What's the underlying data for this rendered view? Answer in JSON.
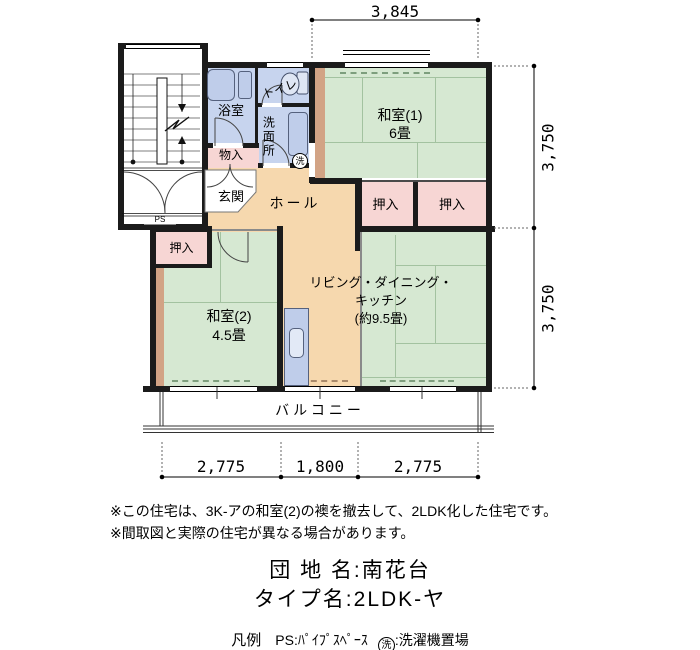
{
  "plan": {
    "rooms": {
      "washitsu1": {
        "name": "和室(1)",
        "size": "6畳"
      },
      "washitsu2": {
        "name": "和室(2)",
        "size": "4.5畳"
      },
      "ldk": {
        "line1": "リビング・ダイニング・",
        "line2": "キッチン",
        "line3": "(約9.5畳)"
      },
      "hall": "ホール",
      "genkan": "玄関",
      "bath": "浴室",
      "toilet": "トイレ",
      "washroom": "洗面所",
      "monoire": "物入",
      "oshiire": "押入",
      "balcony": "バルコニー",
      "ps": "PS",
      "laundry_mark": "洗"
    },
    "dimensions": {
      "top": "3,845",
      "right_upper": "3,750",
      "right_lower": "3,750",
      "bottom_left": "2,775",
      "bottom_center": "1,800",
      "bottom_right": "2,775"
    }
  },
  "notes": {
    "line1": "※この住宅は、3K-アの和室(2)の襖を撤去して、2LDK化した住宅です。",
    "line2": "※間取図と実際の住宅が異なる場合があります。"
  },
  "info": {
    "danchi": "団 地 名:南花台",
    "type": "タイプ名:2LDK-ヤ"
  },
  "legend": {
    "title": "凡例",
    "ps": "PS:ﾊﾟｲﾌﾟｽﾍﾟｰｽ",
    "laundry_symbol": "洗",
    "laundry_text": ":洗濯機置場"
  },
  "colors": {
    "tatami": "#d6e8d2",
    "wet": "#c7d4ee",
    "closet": "#f7d6d4",
    "floor": "#f6d8ae",
    "wood": "#d2a385",
    "wall": "#1b1b1b"
  }
}
